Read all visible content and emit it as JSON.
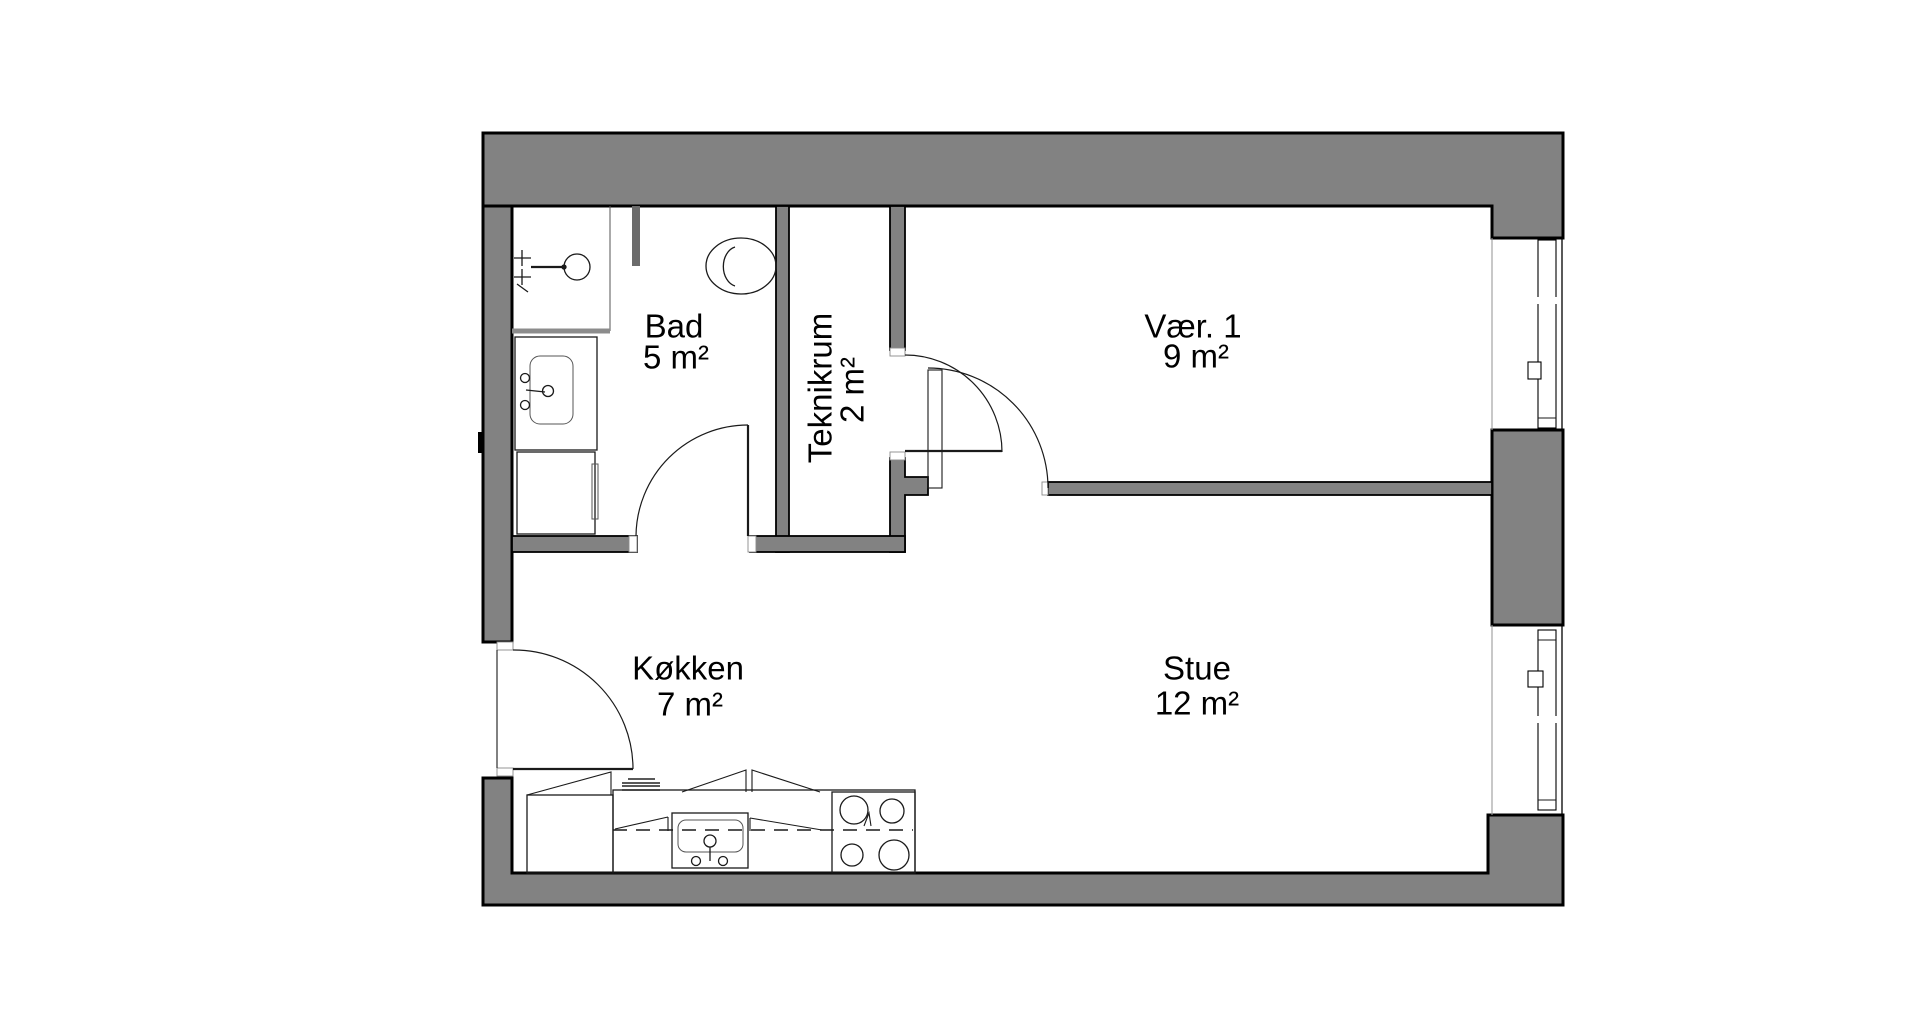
{
  "colors": {
    "wall_fill": "#828282",
    "wall_outline": "#000000",
    "background": "#ffffff",
    "text": "#000000",
    "thin_line": "#1a1a1a"
  },
  "rooms": {
    "bad": {
      "label": "Bad",
      "area": "5 m²"
    },
    "teknikrum": {
      "label": "Teknikrum",
      "area": "2 m²"
    },
    "vaer1": {
      "label": "Vær. 1",
      "area": "9 m²"
    },
    "koekken": {
      "label": "Køkken",
      "area": "7 m²"
    },
    "stue": {
      "label": "Stue",
      "area": "12 m²"
    }
  },
  "fixtures": {
    "bathroom": [
      "shower",
      "toilet",
      "washbasin",
      "washing-machine"
    ],
    "kitchen": [
      "base-cabinet",
      "counter",
      "kitchen-sink",
      "stove-4-burners",
      "radiator-grille"
    ],
    "facade": [
      "window-vaer1",
      "window-stue"
    ],
    "doors": [
      "entrance-door",
      "bathroom-door",
      "teknikrum-door",
      "vaer1-door"
    ]
  }
}
